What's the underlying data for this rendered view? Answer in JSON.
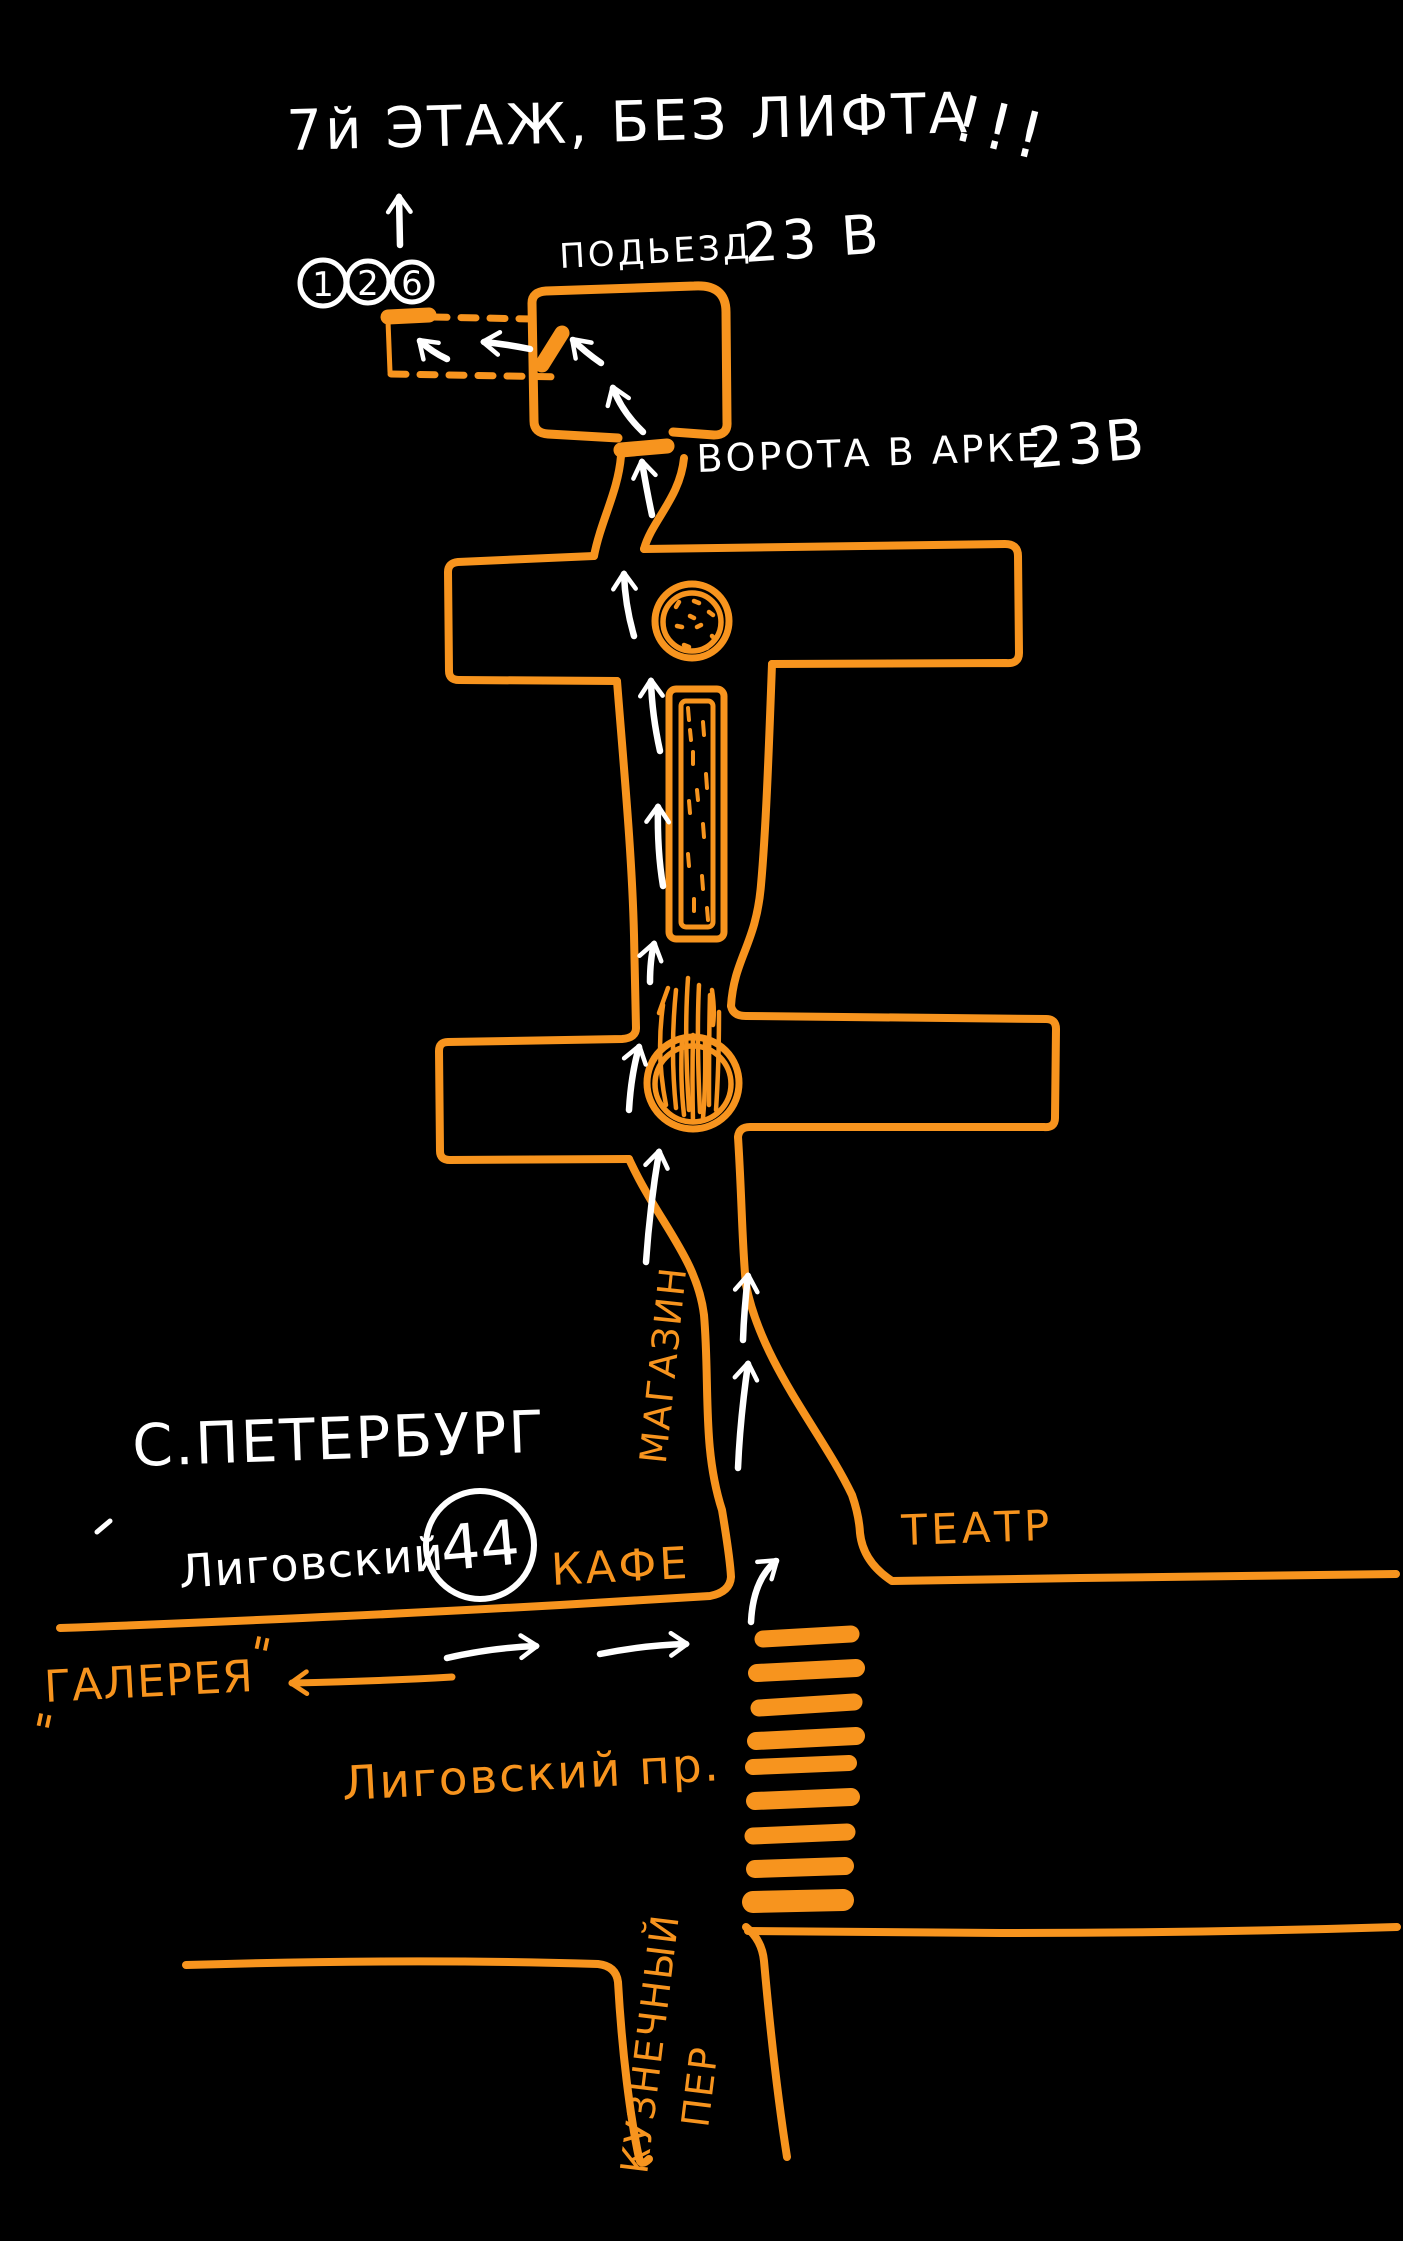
{
  "colors": {
    "background": "#000000",
    "orange": "#F7941E",
    "white": "#FFFFFF"
  },
  "labels": {
    "floor_note": "7й ЭТАЖ, БЕЗ ЛИФТА",
    "floor_note_bang": "!!!",
    "entrance_codes": [
      "1",
      "2",
      "6"
    ],
    "entrance_label": "ПОДЬЕЗД",
    "entrance_number": "23 В",
    "gate_label": "ВОРОТА В АРКЕ",
    "gate_number": "23В",
    "shop": "МАГАЗИН",
    "city": "С.ПЕТЕРБУРГ",
    "street_name": "Лиговский",
    "house_number": "44",
    "cafe": "КАФЕ",
    "theater": "ТЕАТР",
    "gallery": "ГАЛЕРЕЯ",
    "quote_mark": "\"",
    "avenue": "Лиговский пр.",
    "lane_line1": "КУЗНЕЧНЫЙ",
    "lane_line2": "ПЕР"
  }
}
